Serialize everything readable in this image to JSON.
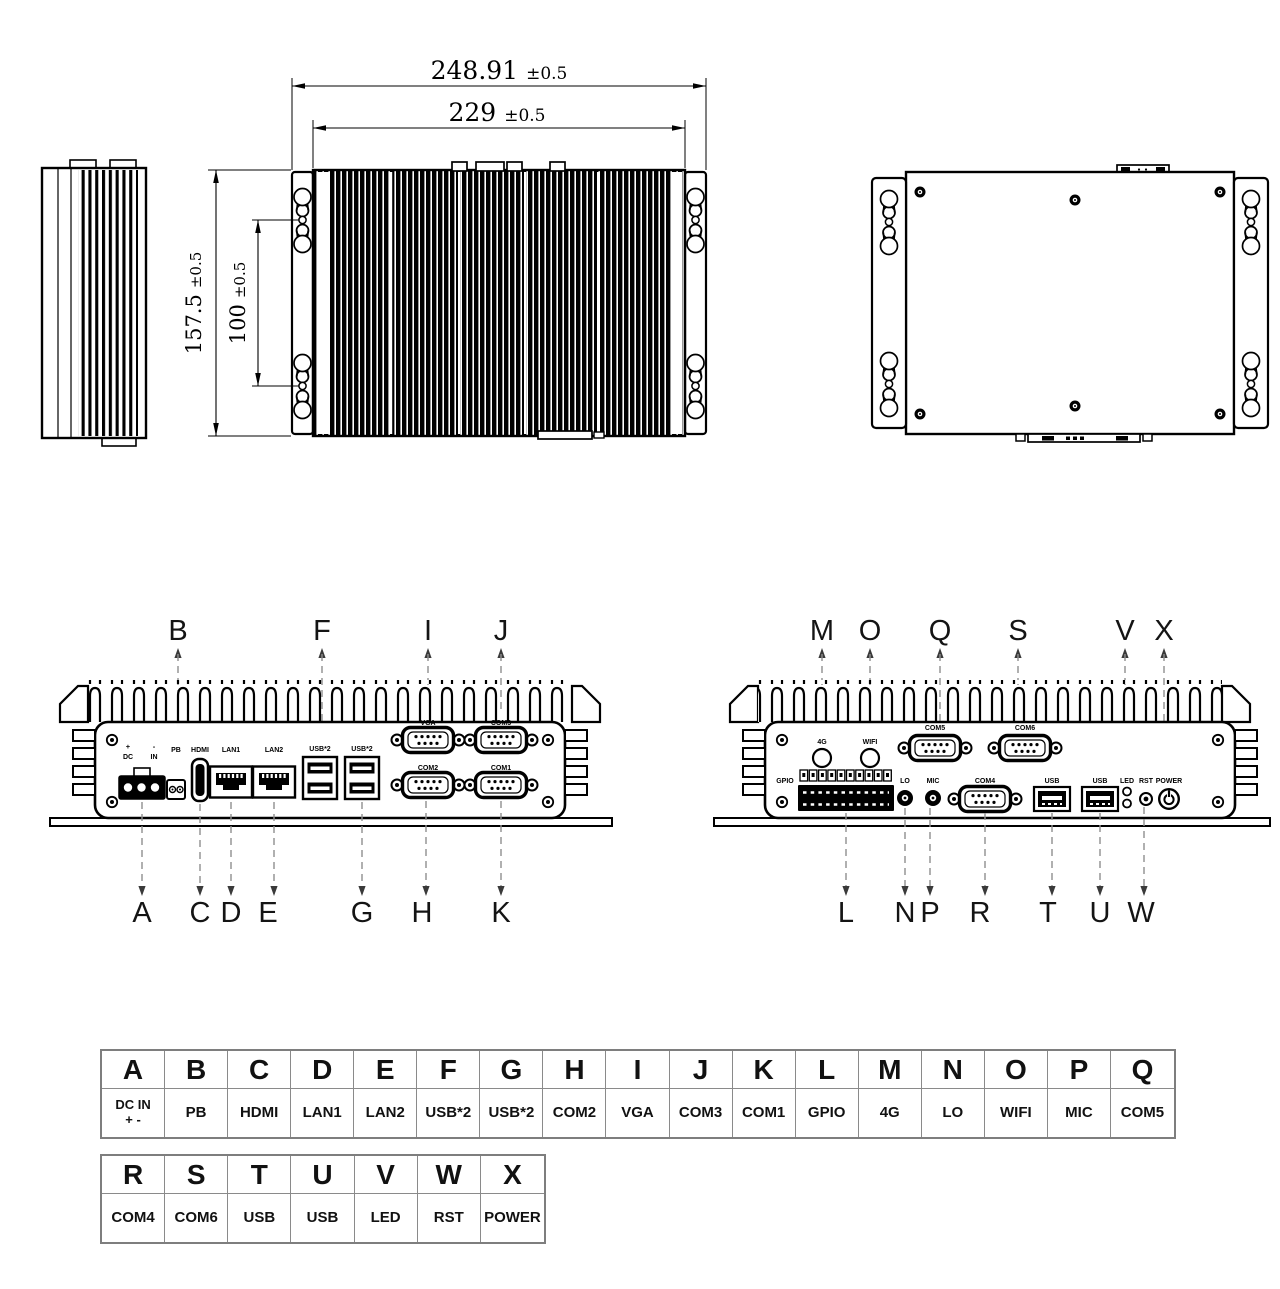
{
  "dims": {
    "outer": {
      "value": "248.91",
      "tol": "±0.5"
    },
    "inner": {
      "value": "229",
      "tol": "±0.5"
    },
    "height": {
      "value": "157.5",
      "tol": "±0.5"
    },
    "pitch": {
      "value": "100",
      "tol": "±0.5"
    }
  },
  "front_view": {
    "callouts_top": [
      "B",
      "F",
      "I",
      "J"
    ],
    "callouts_bottom": [
      "A",
      "C",
      "D",
      "E",
      "G",
      "H",
      "K"
    ],
    "labels": {
      "plus": "+",
      "minus": "-",
      "dc": "DC",
      "in": "IN",
      "pb": "PB",
      "hdmi": "HDMI",
      "lan1": "LAN1",
      "lan2": "LAN2",
      "usb_a": "USB*2",
      "usb_b": "USB*2",
      "vga": "VGA",
      "com3": "COM3",
      "com2": "COM2",
      "com1": "COM1"
    }
  },
  "rear_view": {
    "callouts_top": [
      "M",
      "O",
      "Q",
      "S",
      "V",
      "X"
    ],
    "callouts_bottom": [
      "L",
      "N",
      "P",
      "R",
      "T",
      "U",
      "W"
    ],
    "labels": {
      "g4": "4G",
      "wifi": "WIFI",
      "gpio": "GPIO",
      "lo": "LO",
      "mic": "MIC",
      "com5": "COM5",
      "com6": "COM6",
      "com4": "COM4",
      "usb_a": "USB",
      "usb_b": "USB",
      "led": "LED",
      "rst": "RST",
      "power": "POWER"
    }
  },
  "legend_primary": {
    "headers": [
      "A",
      "B",
      "C",
      "D",
      "E",
      "F",
      "G",
      "H",
      "I",
      "J",
      "K",
      "L",
      "M",
      "N",
      "O",
      "P",
      "Q"
    ],
    "values": [
      "DC IN\n+ -",
      "PB",
      "HDMI",
      "LAN1",
      "LAN2",
      "USB*2",
      "USB*2",
      "COM2",
      "VGA",
      "COM3",
      "COM1",
      "GPIO",
      "4G",
      "LO",
      "WIFI",
      "MIC",
      "COM5"
    ]
  },
  "legend_secondary": {
    "headers": [
      "R",
      "S",
      "T",
      "U",
      "V",
      "W",
      "X"
    ],
    "values": [
      "COM4",
      "COM6",
      "USB",
      "USB",
      "LED",
      "RST",
      "POWER"
    ]
  }
}
